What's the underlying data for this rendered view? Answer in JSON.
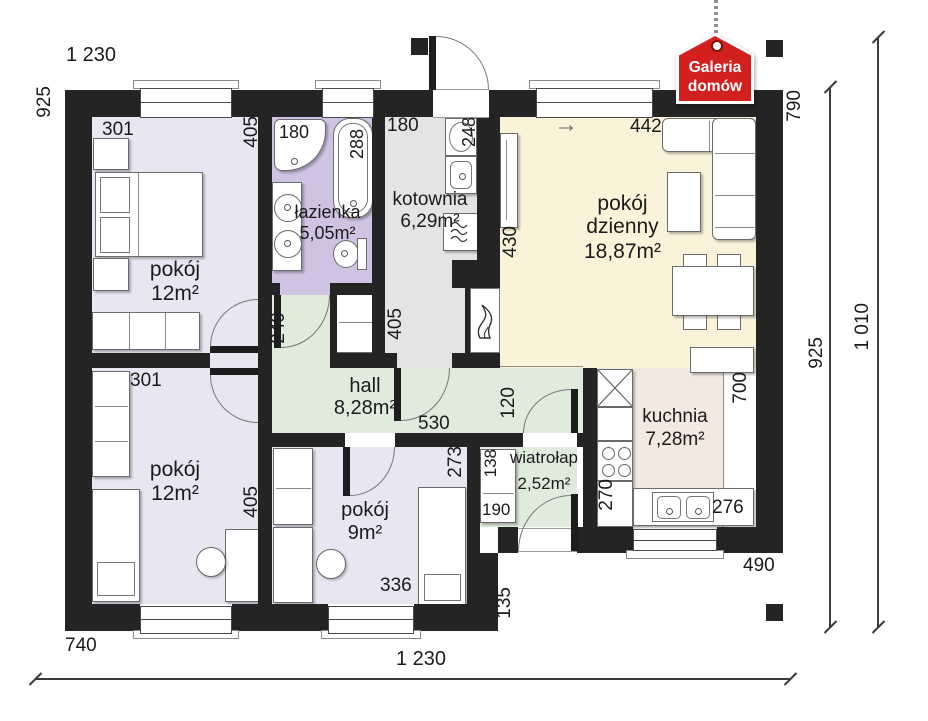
{
  "logo": {
    "line1": "Galeria",
    "line2": "domów",
    "color": "#d2201f"
  },
  "misc": {
    "north_arrow": "→"
  },
  "palette": {
    "wall": "#242424",
    "bedroom": "#e9e5f3",
    "bathroom": "#cfc2e2",
    "boiler_room": "#e3e5e4",
    "living_room": "#faf3da",
    "hall": "#dfecdc",
    "kitchen": "#f3e9df"
  },
  "rooms": [
    {
      "id": "pokoj-gorny",
      "n1": "pokój",
      "n2": "",
      "area": "12m²"
    },
    {
      "id": "lazienka",
      "n1": "łazienka",
      "n2": "",
      "area": "5,05m²"
    },
    {
      "id": "kotownia",
      "n1": "kotownia",
      "n2": "",
      "area": "6,29m²"
    },
    {
      "id": "pokoj-dzienny",
      "n1": "pokój",
      "n2": "dzienny",
      "area": "18,87m²"
    },
    {
      "id": "hall",
      "n1": "hall",
      "n2": "",
      "area": "8,28m²"
    },
    {
      "id": "wiatrolap",
      "n1": "wiatrołap",
      "n2": "",
      "area": "2,52m²"
    },
    {
      "id": "kuchnia",
      "n1": "kuchnia",
      "n2": "",
      "area": "7,28m²"
    },
    {
      "id": "pokoj-dolny",
      "n1": "pokój",
      "n2": "",
      "area": "12m²"
    },
    {
      "id": "pokoj-maly",
      "n1": "pokój",
      "n2": "",
      "area": "9m²"
    }
  ],
  "dims": {
    "top_width": "1 230",
    "left_height": "925",
    "tl_301": "301",
    "tl_405": "405",
    "laz_180": "180",
    "laz_288": "288",
    "kot_180": "180",
    "kot_248": "248",
    "dz_442": "442",
    "right_790": "790",
    "dz_430": "430",
    "hall_249": "249",
    "kot_405": "405",
    "hall_530": "530",
    "hall_120": "120",
    "bl_301": "301",
    "bl_405": "405",
    "p9_273": "273",
    "p9_336": "336",
    "wt_138": "138",
    "wt_190": "190",
    "ku_700": "700",
    "ku_270": "270",
    "ku_276": "276",
    "right_490": "490",
    "step_135": "135",
    "bottom_740": "740",
    "bottom_width": "1 230",
    "right_925": "925",
    "right_1010": "1 010"
  }
}
